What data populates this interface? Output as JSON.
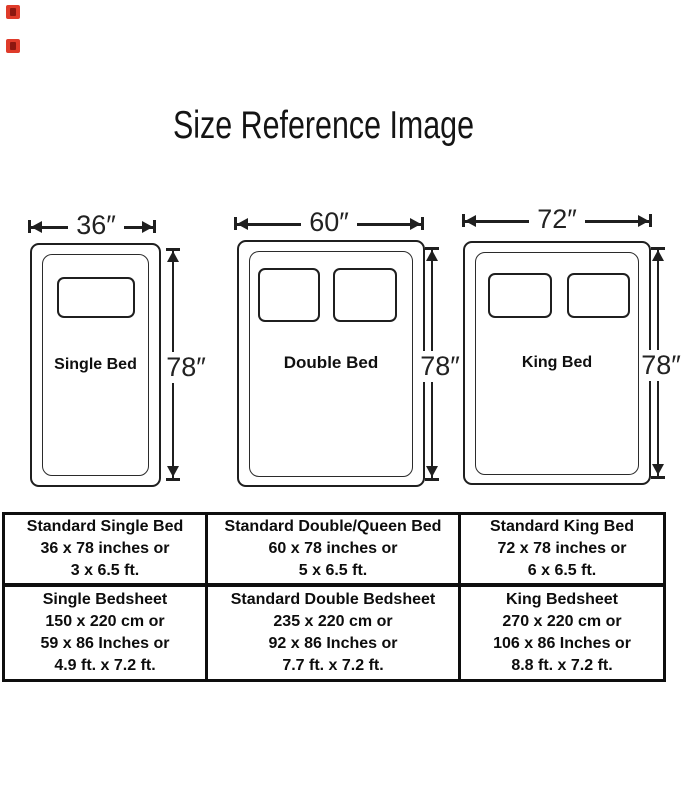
{
  "title": "Size Reference Image",
  "style": {
    "stroke_color": "#1f1f1f",
    "marker_color": "#df3b2a",
    "marker_inner_color": "#8c1710"
  },
  "beds": [
    {
      "name": "Single Bed",
      "width": "36″",
      "height": "78″"
    },
    {
      "name": "Double Bed",
      "width": "60″",
      "height": "78″"
    },
    {
      "name": "King Bed",
      "width": "72″",
      "height": "78″"
    }
  ],
  "table": {
    "rows": [
      {
        "cells": [
          {
            "lines": [
              "Standard Single Bed",
              "36 x 78 inches or",
              "3 x 6.5 ft."
            ]
          },
          {
            "lines": [
              "Standard Double/Queen Bed",
              "60 x 78 inches or",
              "5 x 6.5 ft."
            ]
          },
          {
            "lines": [
              "Standard King Bed",
              "72 x 78 inches or",
              "6 x 6.5 ft."
            ]
          }
        ]
      },
      {
        "cells": [
          {
            "lines": [
              "Single Bedsheet",
              "150 x 220 cm or",
              "59 x 86 Inches or",
              "4.9 ft. x 7.2 ft."
            ]
          },
          {
            "lines": [
              "Standard Double Bedsheet",
              "235 x 220 cm or",
              "92 x 86 Inches or",
              "7.7 ft. x 7.2 ft."
            ]
          },
          {
            "lines": [
              "King Bedsheet",
              "270 x 220 cm or",
              "106 x 86 Inches or",
              "8.8 ft. x 7.2 ft."
            ]
          }
        ]
      }
    ]
  }
}
